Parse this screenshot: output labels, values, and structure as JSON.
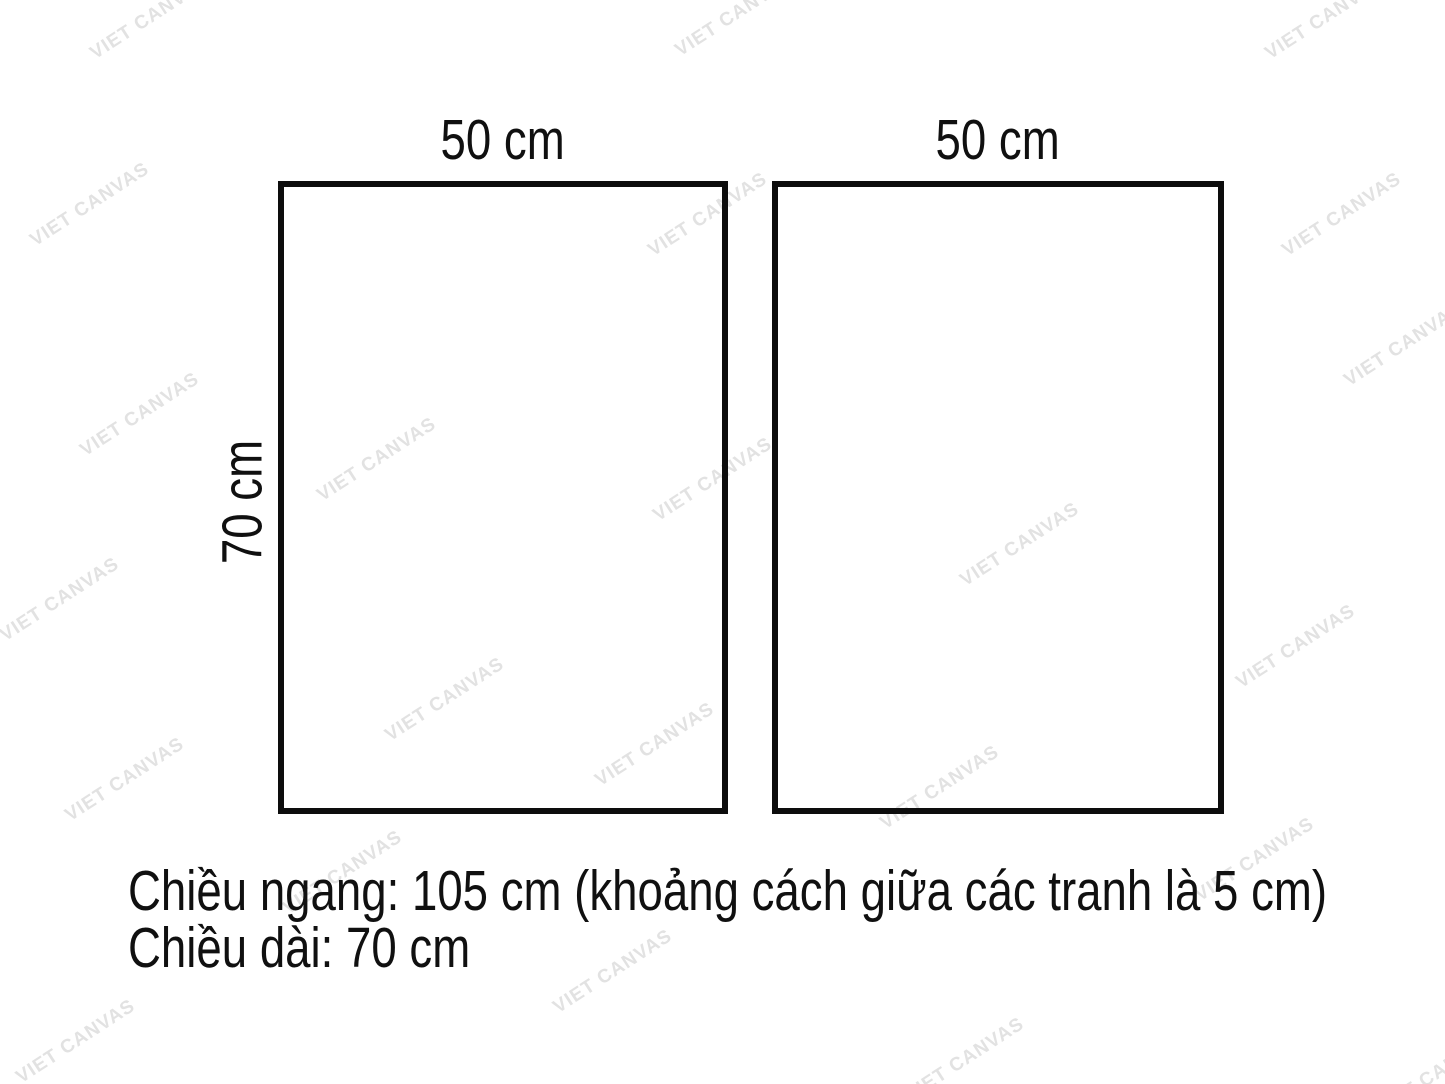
{
  "diagram": {
    "panels": [
      {
        "width_label": "50 cm"
      },
      {
        "width_label": "50 cm"
      }
    ],
    "height_label": "70 cm",
    "caption": {
      "line1": "Chiều ngang: 105 cm (khoảng cách giữa các tranh là 5 cm)",
      "line2": "Chiều dài: 70 cm"
    }
  },
  "watermark": {
    "text": "VIET CANVAS",
    "color": "#e2e2e2",
    "positions": [
      [
        150,
        18
      ],
      [
        735,
        15
      ],
      [
        1325,
        18
      ],
      [
        90,
        205
      ],
      [
        708,
        215
      ],
      [
        1342,
        215
      ],
      [
        140,
        415
      ],
      [
        377,
        460
      ],
      [
        713,
        480
      ],
      [
        1404,
        345
      ],
      [
        1020,
        545
      ],
      [
        60,
        600
      ],
      [
        1296,
        647
      ],
      [
        445,
        700
      ],
      [
        655,
        745
      ],
      [
        125,
        780
      ],
      [
        940,
        788
      ],
      [
        343,
        873
      ],
      [
        1255,
        860
      ],
      [
        613,
        972
      ],
      [
        76,
        1042
      ],
      [
        965,
        1060
      ],
      [
        1435,
        1075
      ]
    ]
  },
  "colors": {
    "background": "#ffffff",
    "border": "#0d0d0d",
    "text": "#101010"
  }
}
